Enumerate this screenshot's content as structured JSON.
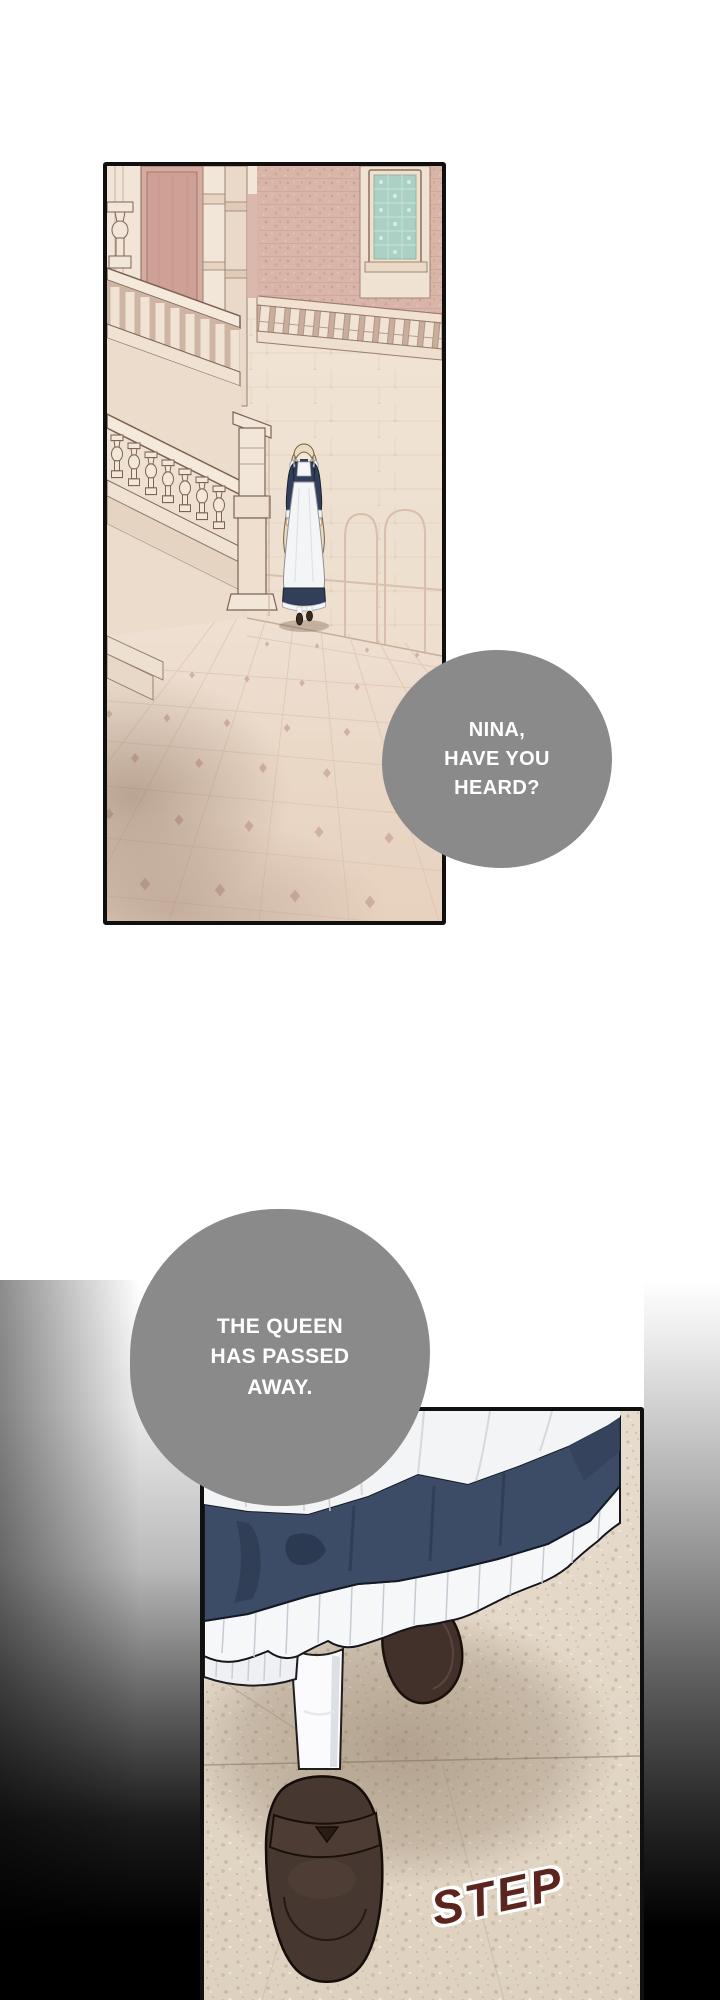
{
  "page": {
    "type": "webtoon comic page",
    "background": "#ffffff"
  },
  "bubbles": [
    {
      "id": "bubble-1",
      "text": "NINA,\nHAVE YOU\nHEARD?",
      "fill": "#8a8a8a",
      "text_color": "#ffffff"
    },
    {
      "id": "bubble-2",
      "text": "THE QUEEN\nHAS PASSED\nAWAY.",
      "fill": "#8a8a8a",
      "text_color": "#ffffff"
    }
  ],
  "sfx": {
    "step": {
      "text": "STEP",
      "color": "#5b241d",
      "outline": "#ffffff"
    }
  },
  "colors": {
    "panel_border": "#101010",
    "hall_wall_cream": "#f0e2d3",
    "hall_wall_pink": "#d6aca1",
    "brick_wall": "#d9b4a9",
    "stained_glass": "#abd0c4",
    "floor_panel1": "#ecdccc",
    "floor_panel2": "#e3d7c7",
    "dress_navy": "#3d4c66",
    "apron_white": "#f4f5f7",
    "loafer_brown": "#463730",
    "vignette_black": "#000000"
  }
}
